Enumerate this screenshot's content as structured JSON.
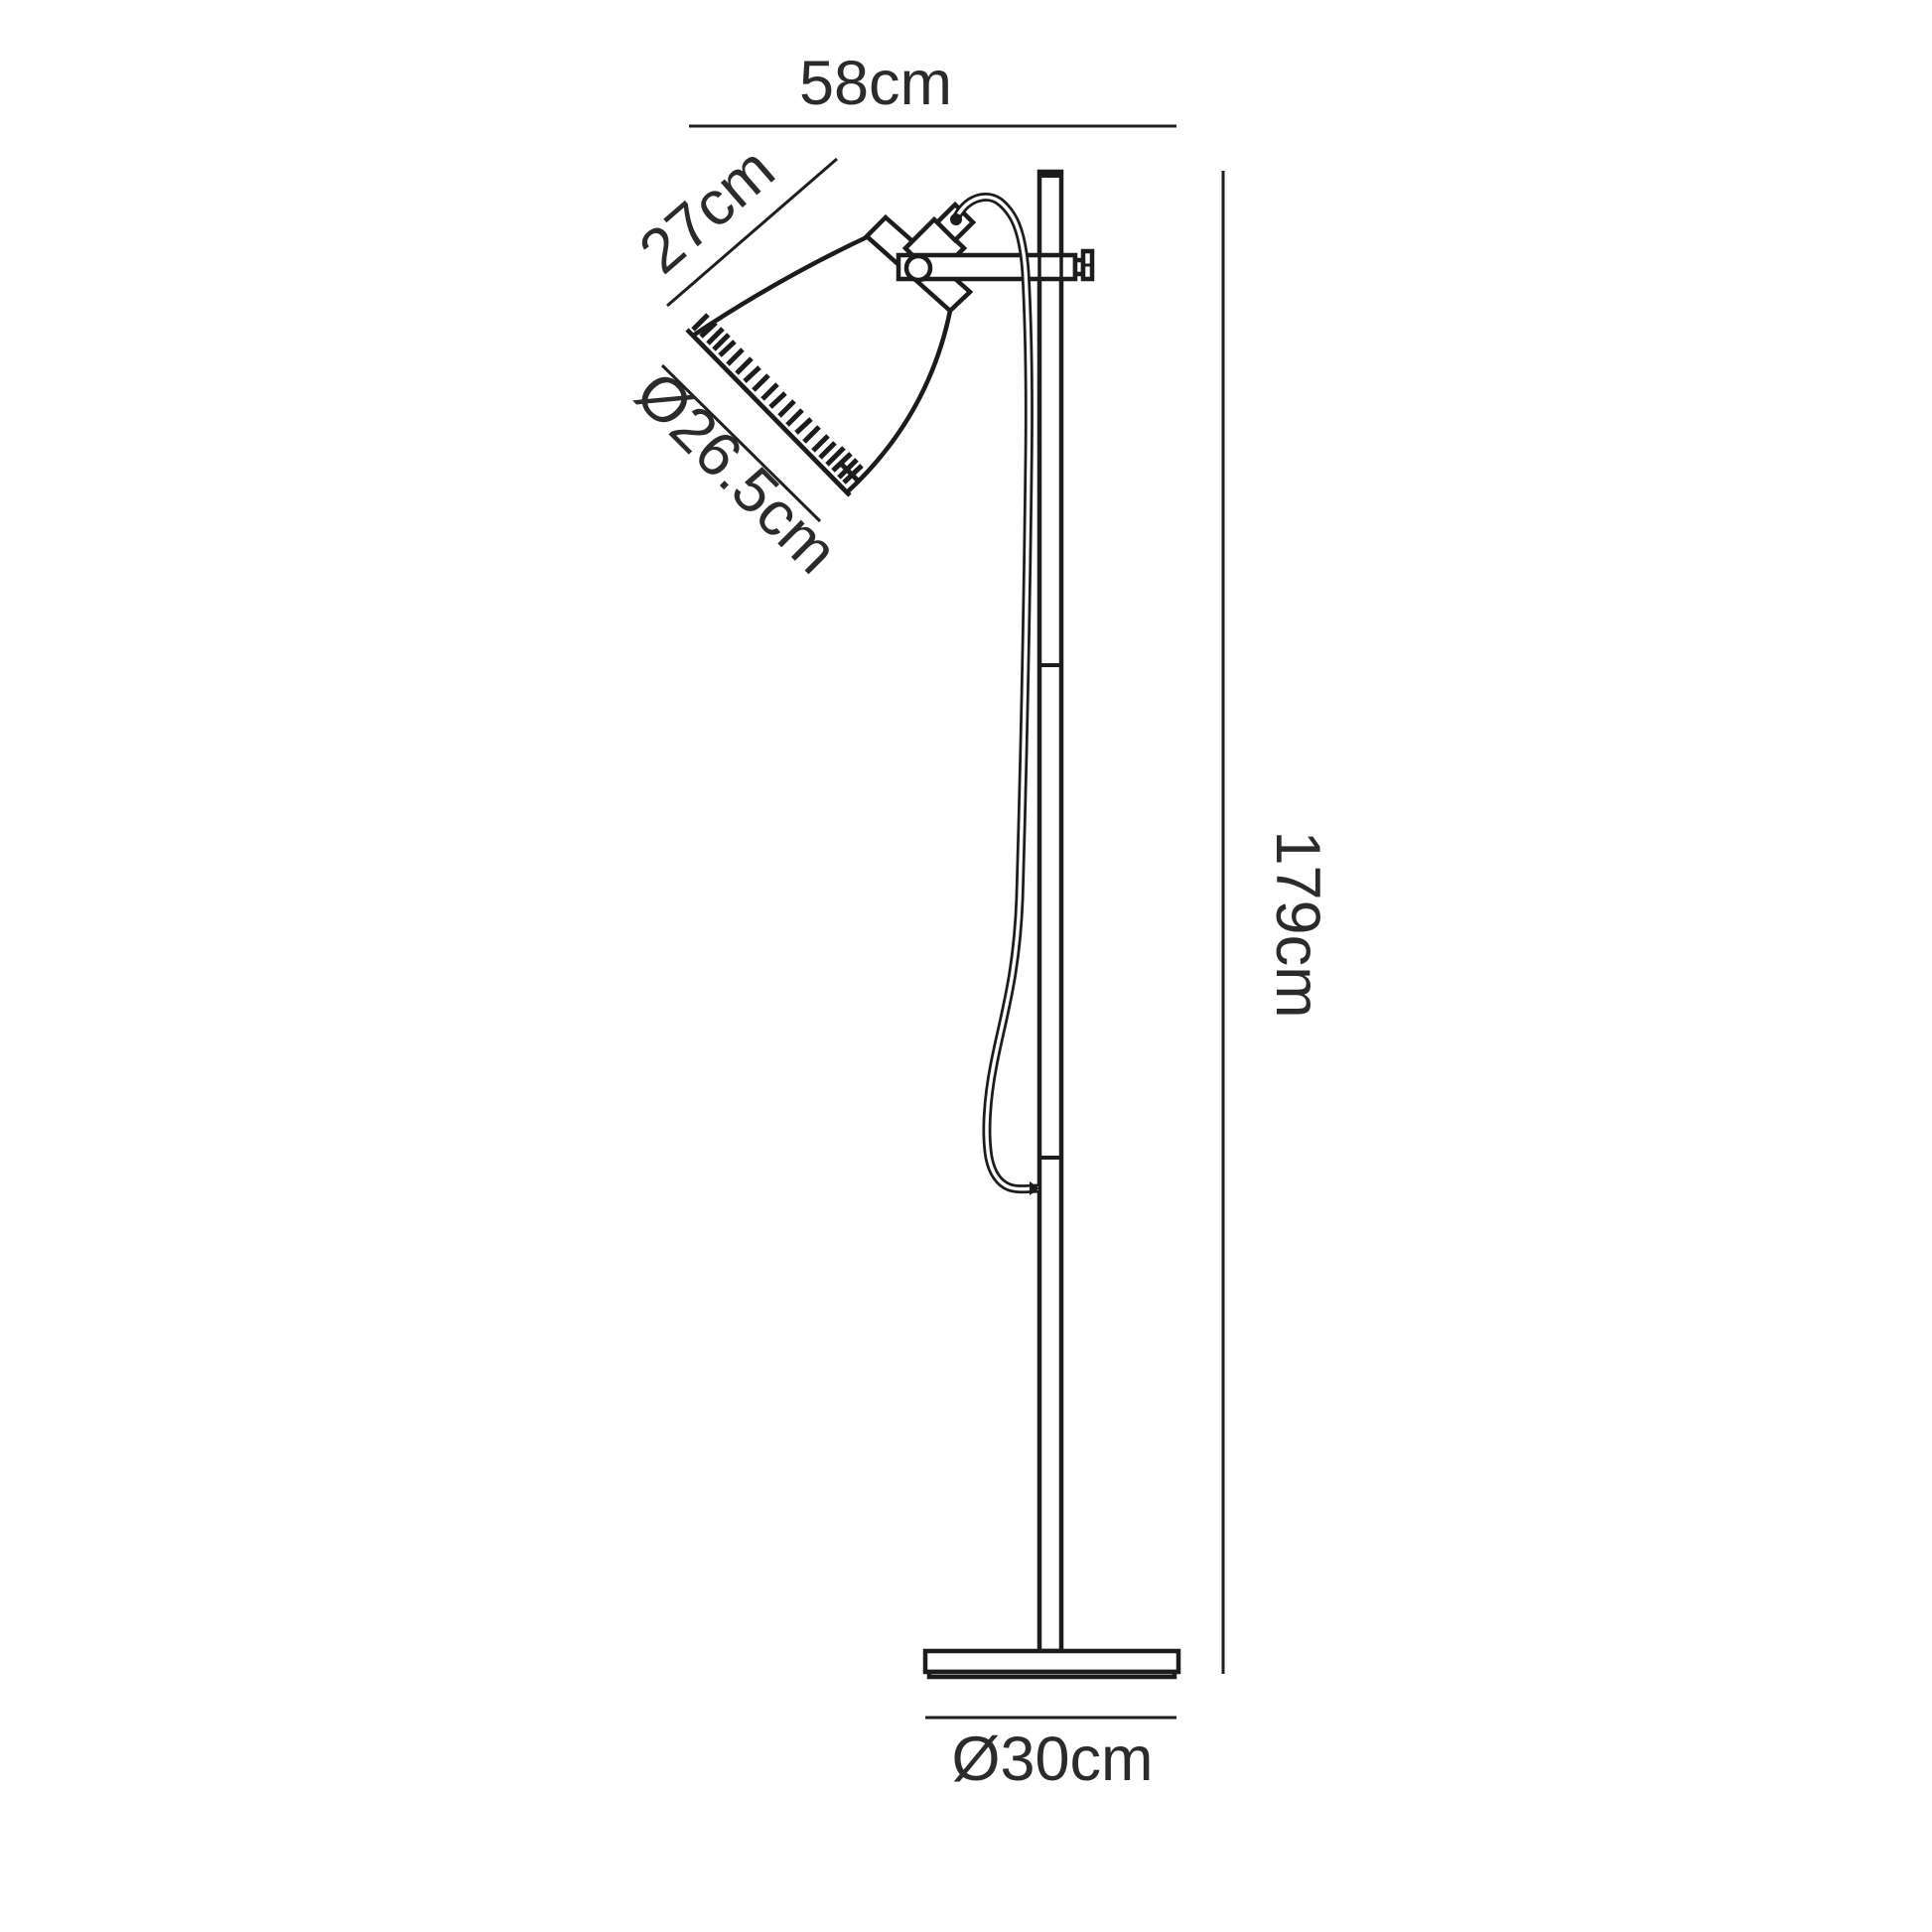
{
  "figure": {
    "kind": "floor-lamp-dimension-drawing",
    "background_color": "#ffffff",
    "line_color": "#1c1c1c",
    "text_color": "#2b2b2b"
  },
  "dimensions": {
    "overall_width": {
      "label": "58cm"
    },
    "shade_length": {
      "label": "27cm"
    },
    "shade_diameter": {
      "label": "Ø26.5cm"
    },
    "overall_height": {
      "label": "179cm"
    },
    "base_diameter": {
      "label": "Ø30cm"
    }
  }
}
